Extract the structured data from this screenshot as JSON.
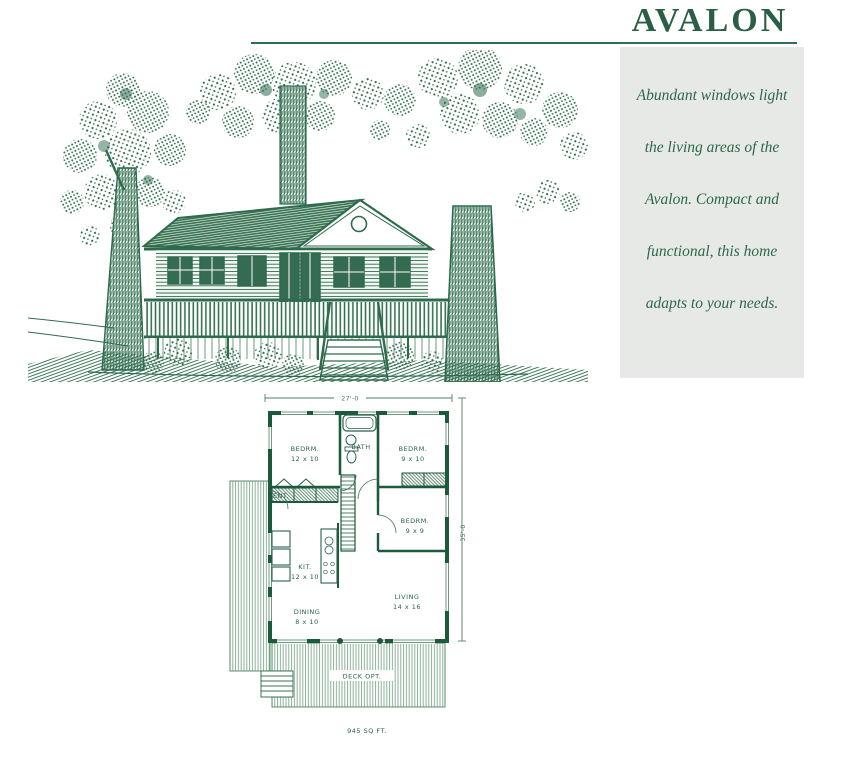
{
  "page": {
    "title": "AVALON"
  },
  "sidebar": {
    "lines": [
      "Abundant windows light",
      "the living areas of the",
      "Avalon. Compact and",
      "functional, this home",
      "adapts to your needs."
    ]
  },
  "floor_plan": {
    "dim_width": "27'-0",
    "dim_depth": "35'-0",
    "rooms": {
      "bedroom1": {
        "name": "BEDRM.",
        "size": "12 x 10"
      },
      "bath": {
        "name": "BATH"
      },
      "bedroom2": {
        "name": "BEDRM.",
        "size": "9 x 10"
      },
      "bedroom3": {
        "name": "BEDRM.",
        "size": "9 x 9"
      },
      "entry": {
        "name": "ENT."
      },
      "kitchen": {
        "name": "KIT.",
        "size": "12 x 10"
      },
      "dining": {
        "name": "DINING",
        "size": "8 x 10"
      },
      "living": {
        "name": "LIVING",
        "size": "14 x 16"
      },
      "deck": {
        "name": "DECK OPT."
      }
    },
    "area": "945 SQ FT."
  },
  "colors": {
    "accent_green": "#2a5f45",
    "ink_green": "#2e6b4d",
    "wall_green": "#1d5a3b",
    "sidebar_bg": "#e7e9e6",
    "stripe_green": "#8bb098"
  }
}
